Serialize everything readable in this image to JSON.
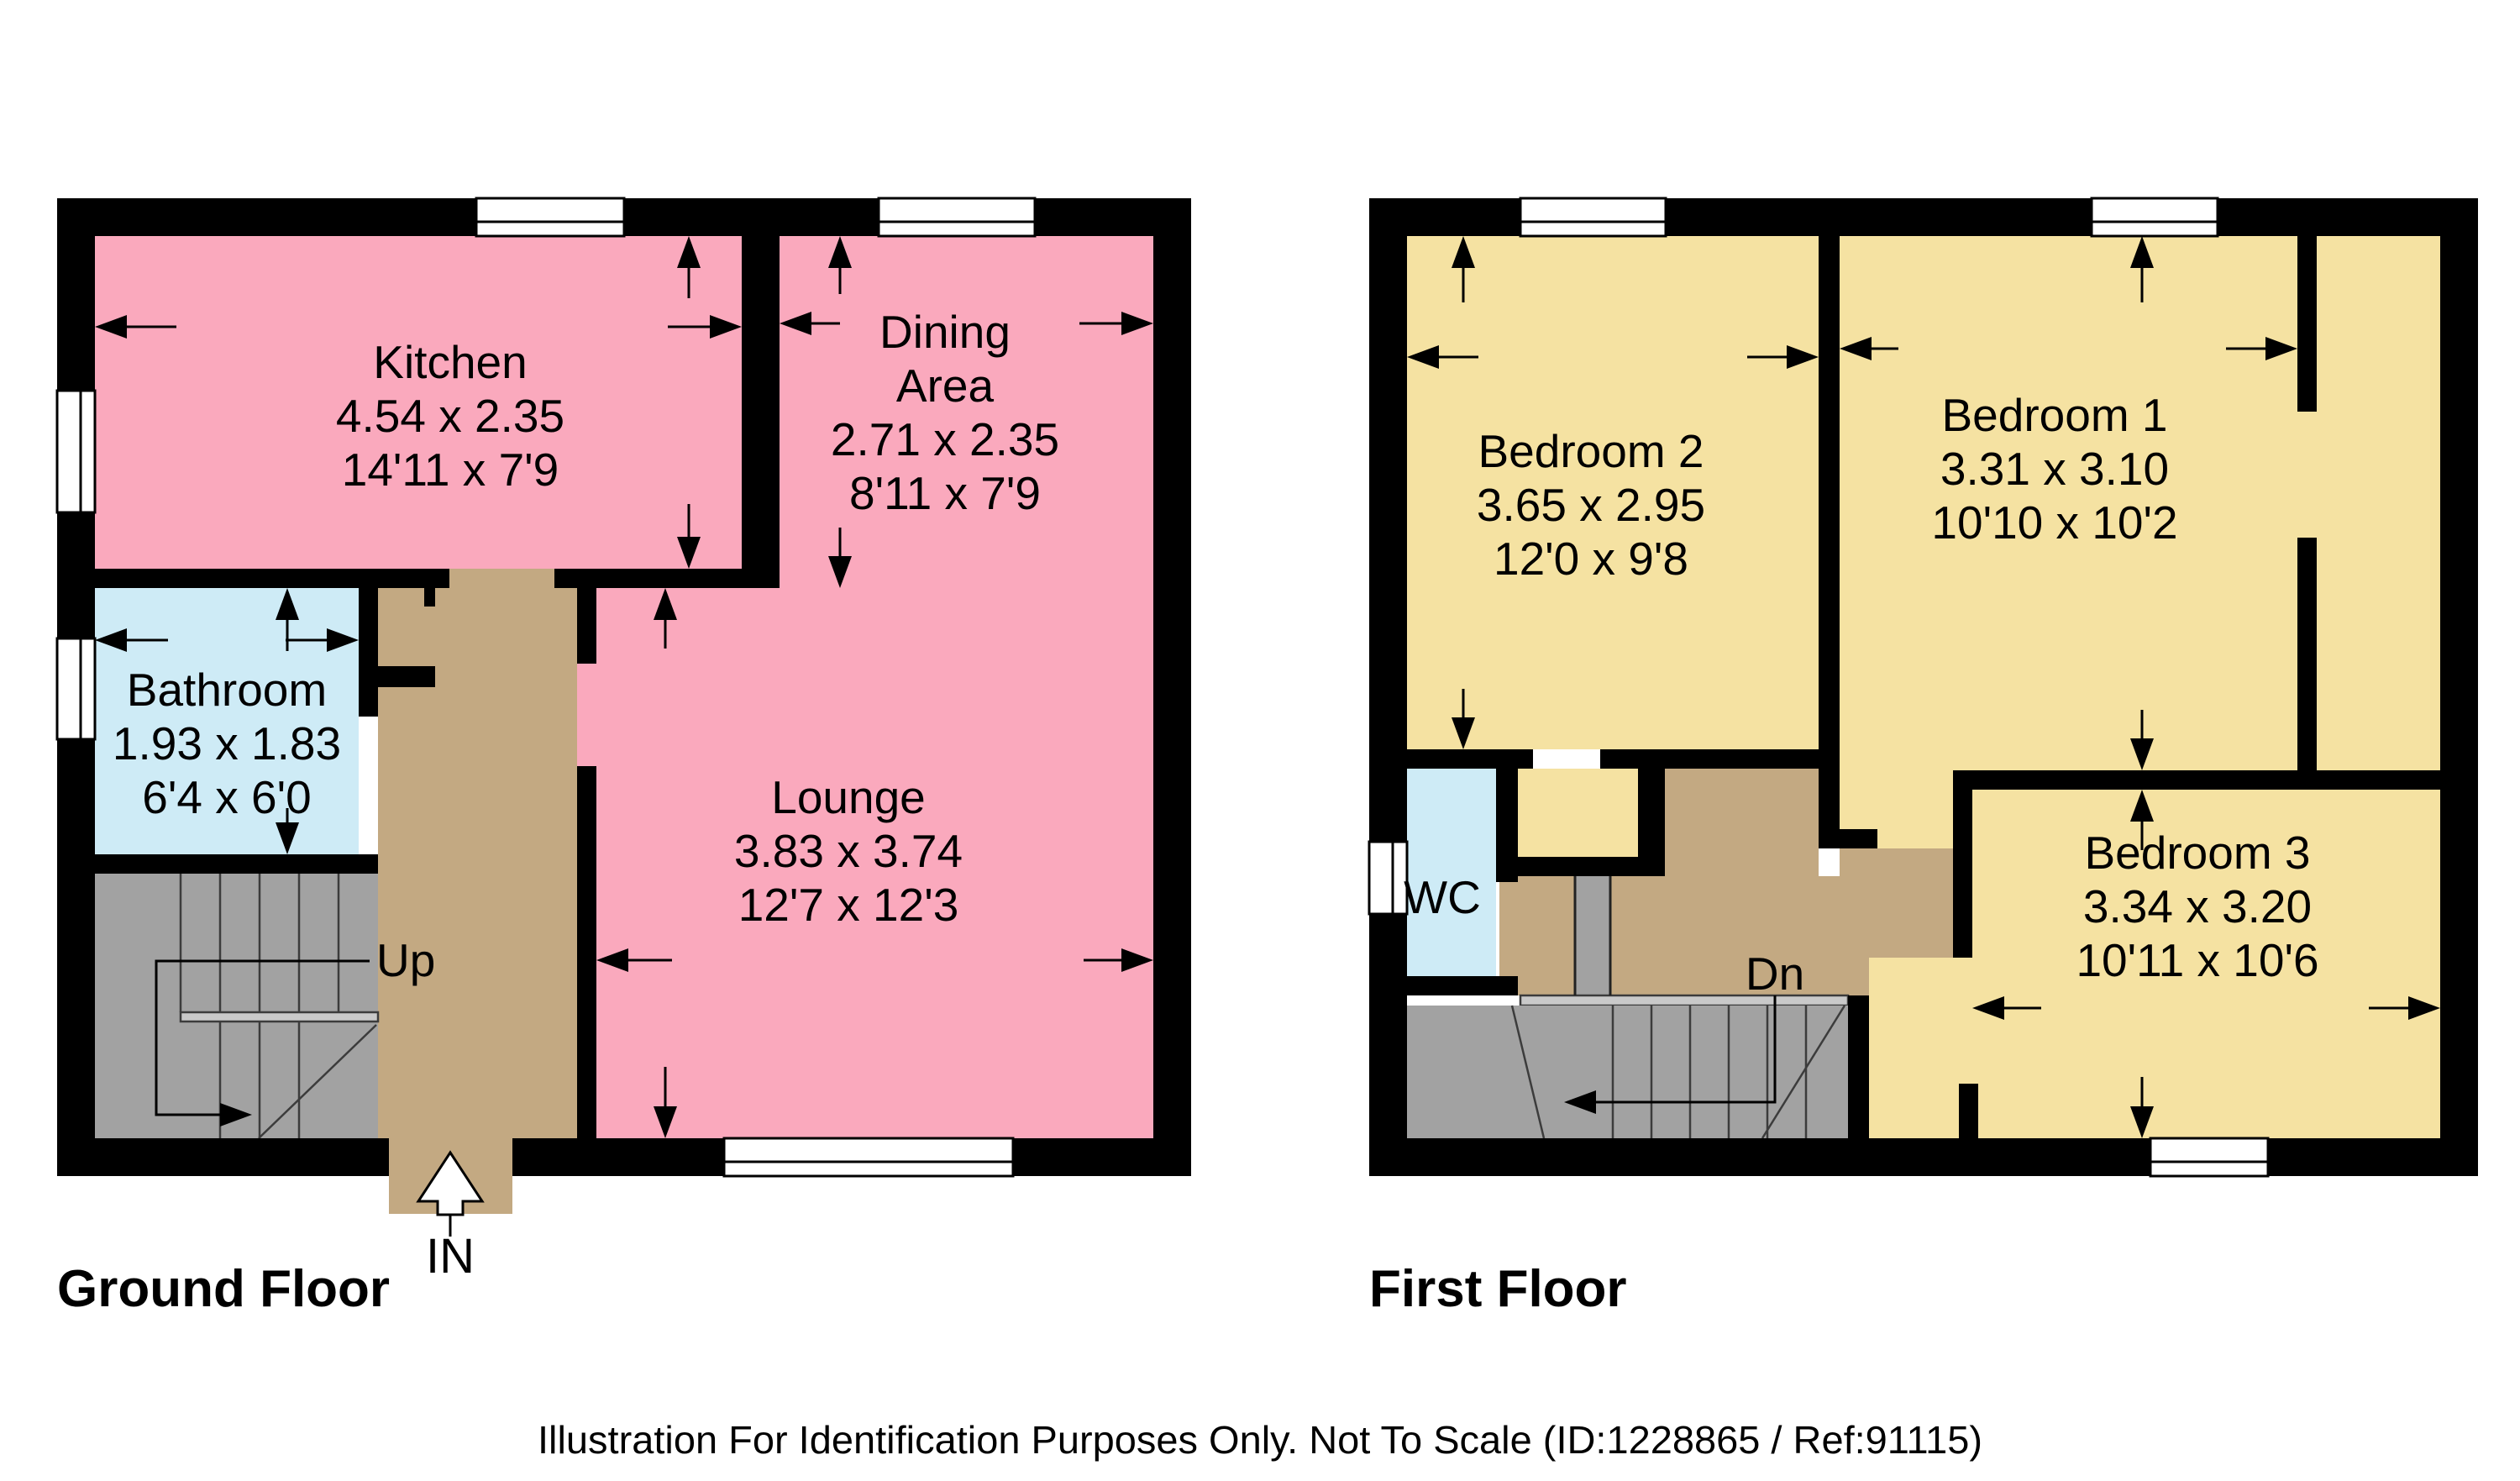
{
  "colors": {
    "pink": "#FAA9BD",
    "yellow": "#F5E2A2",
    "blue": "#CEEBF6",
    "tan": "#C3A982",
    "gray": "#A2A2A2",
    "gray_light": "#C9C9C9",
    "wall": "#000000",
    "background": "#FFFFFF"
  },
  "ground_floor": {
    "title": "Ground Floor",
    "stairs_label": "Up",
    "entrance_label": "IN",
    "rooms": {
      "kitchen": {
        "name": "Kitchen",
        "metric": "4.54 x 2.35",
        "imperial": "14'11 x 7'9"
      },
      "dining_area": {
        "name_line1": "Dining",
        "name_line2": "Area",
        "metric": "2.71 x 2.35",
        "imperial": "8'11 x 7'9"
      },
      "bathroom": {
        "name": "Bathroom",
        "metric": "1.93 x 1.83",
        "imperial": "6'4 x 6'0"
      },
      "lounge": {
        "name": "Lounge",
        "metric": "3.83 x 3.74",
        "imperial": "12'7 x 12'3"
      }
    }
  },
  "first_floor": {
    "title": "First Floor",
    "stairs_label": "Dn",
    "rooms": {
      "bedroom_2": {
        "name": "Bedroom 2",
        "metric": "3.65 x 2.95",
        "imperial": "12'0 x 9'8"
      },
      "bedroom_1": {
        "name": "Bedroom 1",
        "metric": "3.31 x 3.10",
        "imperial": "10'10 x 10'2"
      },
      "wc": {
        "name": "WC"
      },
      "bedroom_3": {
        "name": "Bedroom 3",
        "metric": "3.34 x 3.20",
        "imperial": "10'11 x 10'6"
      }
    }
  },
  "footer": {
    "disclaimer": "Illustration For Identification Purposes Only. Not To Scale (ID:1228865 / Ref:91115)"
  }
}
